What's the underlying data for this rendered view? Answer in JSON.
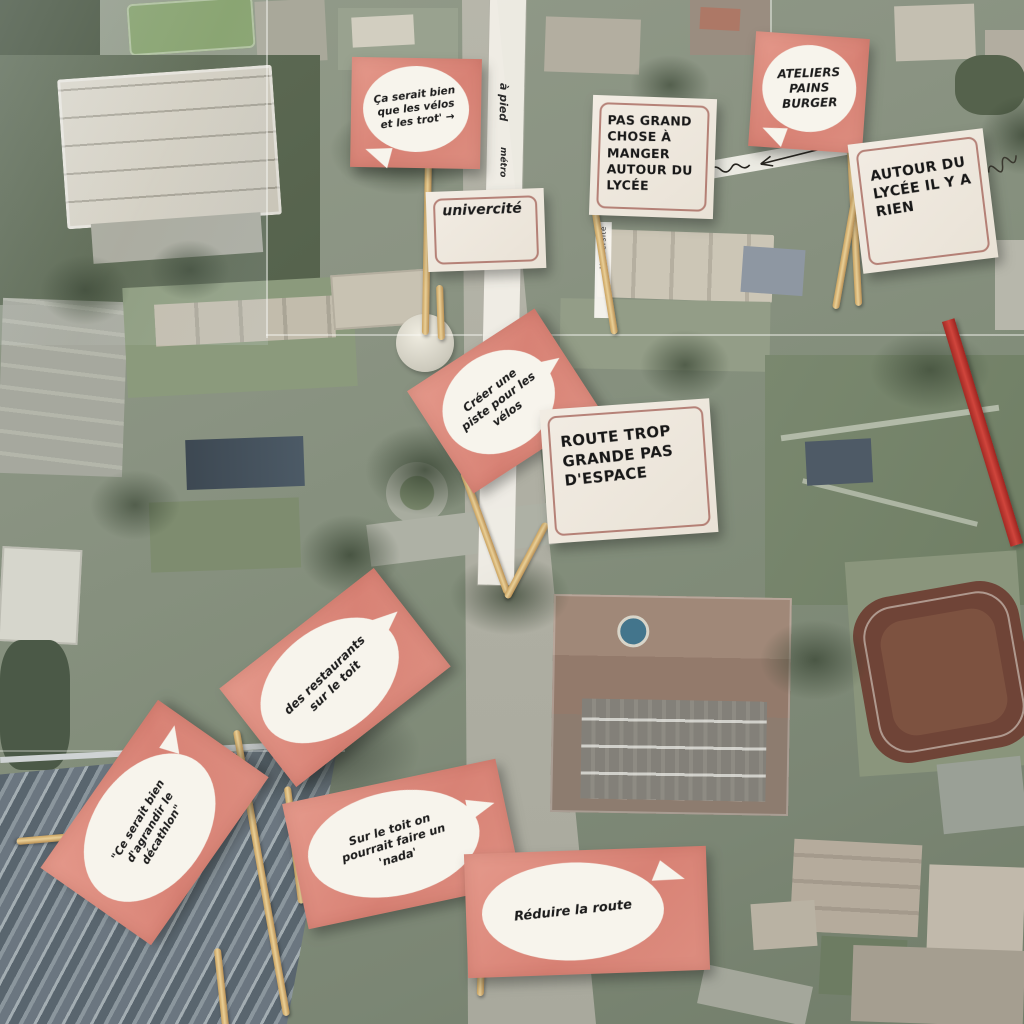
{
  "flags": [
    {
      "name": "flag-velos-trot",
      "style": "pink-bubble",
      "text": "Ça serait bien que les vélos et les trot' →"
    },
    {
      "name": "flag-univercite",
      "style": "cream-bordered",
      "text": "univercité"
    },
    {
      "name": "flag-pas-grand-chose",
      "style": "cream-bordered",
      "text": "PAS GRAND CHOSE À MANGER AUTOUR DU LYCÉE"
    },
    {
      "name": "flag-ateliers",
      "style": "pink-bubble",
      "text": "ATELIERS PAINS BURGER"
    },
    {
      "name": "flag-autour-lycee",
      "style": "cream-bordered",
      "text": "AUTOUR DU LYCÉE IL Y A RIEN"
    },
    {
      "name": "flag-creer-piste",
      "style": "pink-bubble",
      "text": "Créer une piste pour les vélos"
    },
    {
      "name": "flag-route-trop-grande",
      "style": "cream-bordered",
      "text": "ROUTE TROP GRANDE PAS D'ESPACE"
    },
    {
      "name": "flag-restaurants",
      "style": "pink-bubble",
      "text": "des restaurants sur le toit"
    },
    {
      "name": "flag-decathlon",
      "style": "pink-bubble",
      "text": "\"Ce serait bien d'agrandir le décathlon\""
    },
    {
      "name": "flag-sur-le-toit",
      "style": "pink-bubble",
      "text": "Sur le toit on pourrait faire un 'nada'"
    },
    {
      "name": "flag-reduire",
      "style": "pink-bubble",
      "text": "Réduire la route"
    }
  ],
  "map_annotations": {
    "path_label_1": "à pied",
    "path_label_2": "métro",
    "street_strip_label": "Université"
  },
  "colors": {
    "flag_pink": "#dd8e80",
    "flag_cream": "#efe8df",
    "flag_border": "#9c564c",
    "bubble_white": "#f7f4ec",
    "ink": "#1b1b1b",
    "stick": "#d9b87e",
    "ribbon_red": "#c03a30"
  }
}
